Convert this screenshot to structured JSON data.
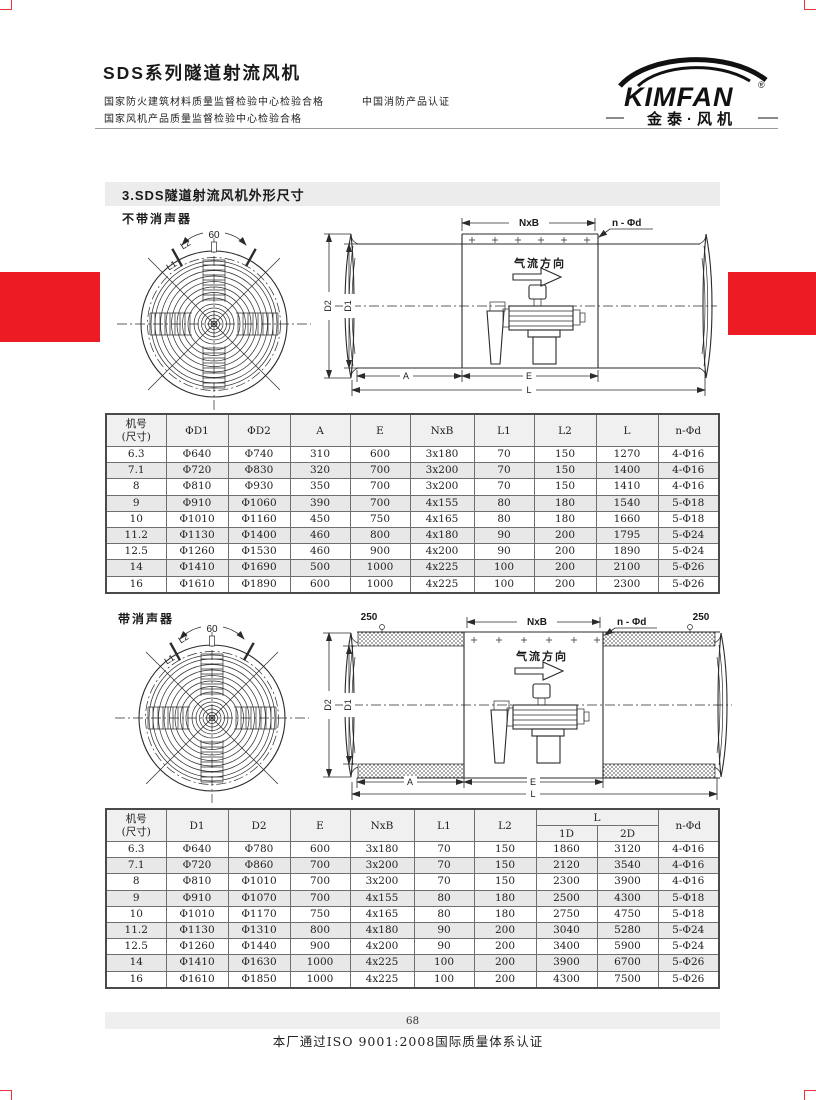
{
  "header": {
    "title": "SDS系列隧道射流风机",
    "cert_fire": "国家防火建筑材料质量监督检验中心检验合格",
    "cert_china_fire": "中国消防产品认证",
    "cert_fan": "国家风机产品质量监督检验中心检验合格",
    "logo": {
      "brand": "KIMFAN",
      "reg": "®",
      "cn": "金泰·风机"
    }
  },
  "section": {
    "title": "3.SDS隧道射流风机外形尺寸"
  },
  "diagrams": {
    "without_label": "不带消声器",
    "with_label": "带消声器",
    "angle": "60",
    "l2": "L2",
    "l1": "L1",
    "nxb": "NxB",
    "n_phi_d": "n - Φd",
    "airflow": "气流方向",
    "d2": "D2",
    "d1": "D1",
    "a": "A",
    "e": "E",
    "l": "L",
    "silencer_left": "250",
    "silencer_right": "250"
  },
  "table1": {
    "headers": [
      "机号\n(尺寸)",
      "ΦD1",
      "ΦD2",
      "A",
      "E",
      "NxB",
      "L1",
      "L2",
      "L",
      "n-Φd"
    ],
    "rows": [
      [
        "6.3",
        "Φ640",
        "Φ740",
        "310",
        "600",
        "3x180",
        "70",
        "150",
        "1270",
        "4-Φ16"
      ],
      [
        "7.1",
        "Φ720",
        "Φ830",
        "320",
        "700",
        "3x200",
        "70",
        "150",
        "1400",
        "4-Φ16"
      ],
      [
        "8",
        "Φ810",
        "Φ930",
        "350",
        "700",
        "3x200",
        "70",
        "150",
        "1410",
        "4-Φ16"
      ],
      [
        "9",
        "Φ910",
        "Φ1060",
        "390",
        "700",
        "4x155",
        "80",
        "180",
        "1540",
        "5-Φ18"
      ],
      [
        "10",
        "Φ1010",
        "Φ1160",
        "450",
        "750",
        "4x165",
        "80",
        "180",
        "1660",
        "5-Φ18"
      ],
      [
        "11.2",
        "Φ1130",
        "Φ1400",
        "460",
        "800",
        "4x180",
        "90",
        "200",
        "1795",
        "5-Φ24"
      ],
      [
        "12.5",
        "Φ1260",
        "Φ1530",
        "460",
        "900",
        "4x200",
        "90",
        "200",
        "1890",
        "5-Φ24"
      ],
      [
        "14",
        "Φ1410",
        "Φ1690",
        "500",
        "1000",
        "4x225",
        "100",
        "200",
        "2100",
        "5-Φ26"
      ],
      [
        "16",
        "Φ1610",
        "Φ1890",
        "600",
        "1000",
        "4x225",
        "100",
        "200",
        "2300",
        "5-Φ26"
      ]
    ]
  },
  "table2": {
    "headers": [
      "机号\n(尺寸)",
      "D1",
      "D2",
      "E",
      "NxB",
      "L1",
      "L2",
      "L",
      "n-Φd"
    ],
    "sub_headers": [
      "1D",
      "2D"
    ],
    "rows": [
      [
        "6.3",
        "Φ640",
        "Φ780",
        "600",
        "3x180",
        "70",
        "150",
        "1860",
        "3120",
        "4-Φ16"
      ],
      [
        "7.1",
        "Φ720",
        "Φ860",
        "700",
        "3x200",
        "70",
        "150",
        "2120",
        "3540",
        "4-Φ16"
      ],
      [
        "8",
        "Φ810",
        "Φ1010",
        "700",
        "3x200",
        "70",
        "150",
        "2300",
        "3900",
        "4-Φ16"
      ],
      [
        "9",
        "Φ910",
        "Φ1070",
        "700",
        "4x155",
        "80",
        "180",
        "2500",
        "4300",
        "5-Φ18"
      ],
      [
        "10",
        "Φ1010",
        "Φ1170",
        "750",
        "4x165",
        "80",
        "180",
        "2750",
        "4750",
        "5-Φ18"
      ],
      [
        "11.2",
        "Φ1130",
        "Φ1310",
        "800",
        "4x180",
        "90",
        "200",
        "3040",
        "5280",
        "5-Φ24"
      ],
      [
        "12.5",
        "Φ1260",
        "Φ1440",
        "900",
        "4x200",
        "90",
        "200",
        "3400",
        "5900",
        "5-Φ24"
      ],
      [
        "14",
        "Φ1410",
        "Φ1630",
        "1000",
        "4x225",
        "100",
        "200",
        "3900",
        "6700",
        "5-Φ26"
      ],
      [
        "16",
        "Φ1610",
        "Φ1850",
        "1000",
        "4x225",
        "100",
        "200",
        "4300",
        "7500",
        "5-Φ26"
      ]
    ]
  },
  "footer": {
    "page_number": "68",
    "iso": "本厂通过ISO 9001:2008国际质量体系认证"
  },
  "colors": {
    "accent_red": "#ED1C24"
  }
}
